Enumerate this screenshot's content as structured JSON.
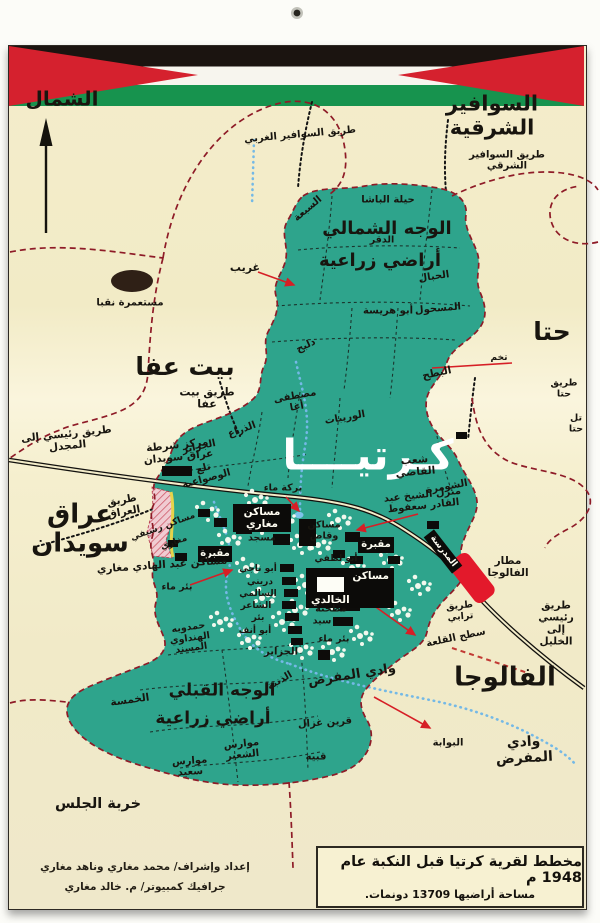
{
  "colors": {
    "paper_cream": "#f3ecc9",
    "village_green": "#2ea48c",
    "boundary_maroon": "#8e1b27",
    "arrow_red": "#d61f26",
    "wadi_blue": "#74b9e6",
    "flag_black": "#1b1410",
    "flag_white": "#f7f5ee",
    "flag_green": "#17934e",
    "flag_red": "#d5212e",
    "airport_red": "#e3192b"
  },
  "caption": {
    "line1": "مخطط لقرية كرتيا قبل النكبة عام 1948 م",
    "line2": "مساحة أراضيها 13709 دونمات."
  },
  "credits": {
    "line1": "إعداد وإشراف/ محمد مغاري وناهد مغاري",
    "line2": "جرافيك كمبيوتر/ م. خالد مغاري"
  },
  "compass": {
    "label": "الشمال"
  },
  "map": {
    "labels": [
      {
        "t": "الشمال",
        "x": 62,
        "y": 99,
        "s": 20
      },
      {
        "t": "السوافير الشرقية",
        "x": 492,
        "y": 116,
        "s": 21
      },
      {
        "t": "طريق السوافير الغربي",
        "x": 300,
        "y": 135,
        "s": 10,
        "r": -5
      },
      {
        "t": "طريق السوافير\nالشرقي",
        "x": 507,
        "y": 161,
        "s": 10
      },
      {
        "t": "حيلة الباشا",
        "x": 388,
        "y": 200,
        "s": 10
      },
      {
        "t": "السبعة",
        "x": 308,
        "y": 209,
        "s": 10,
        "r": -40
      },
      {
        "t": "الوجه الشمالي",
        "x": 387,
        "y": 229,
        "s": 18
      },
      {
        "t": "الدقر",
        "x": 382,
        "y": 241,
        "s": 9.5
      },
      {
        "t": "أراضي زراعية",
        "x": 380,
        "y": 261,
        "s": 18
      },
      {
        "t": "الحبال",
        "x": 434,
        "y": 277,
        "s": 10,
        "r": -8
      },
      {
        "t": "غريب",
        "x": 245,
        "y": 268,
        "s": 11
      },
      {
        "t": "المسحول",
        "x": 438,
        "y": 309,
        "s": 10,
        "r": -5
      },
      {
        "t": "أبو هريسة",
        "x": 388,
        "y": 311,
        "s": 10
      },
      {
        "t": "دلبح",
        "x": 306,
        "y": 346,
        "s": 10,
        "r": -25
      },
      {
        "t": "حتا",
        "x": 552,
        "y": 332,
        "s": 25
      },
      {
        "t": "تخم",
        "x": 499,
        "y": 358,
        "s": 9
      },
      {
        "t": "بيت عفا",
        "x": 185,
        "y": 367,
        "s": 25
      },
      {
        "t": "طريق بيت\nعفا",
        "x": 207,
        "y": 399,
        "s": 11
      },
      {
        "t": "البطح",
        "x": 437,
        "y": 374,
        "s": 10.5,
        "r": -12
      },
      {
        "t": "مصطفى\nأغا",
        "x": 296,
        "y": 402,
        "s": 10,
        "r": -10
      },
      {
        "t": "الوريبات",
        "x": 345,
        "y": 418,
        "s": 10,
        "r": -10
      },
      {
        "t": "طريق\nحتا",
        "x": 564,
        "y": 389,
        "s": 9.5
      },
      {
        "t": "تل حتا",
        "x": 576,
        "y": 424,
        "s": 9.5
      },
      {
        "t": "طريق رئيسي إلى\nالمجدل",
        "x": 67,
        "y": 441,
        "s": 10.5,
        "r": -6
      },
      {
        "t": "مركز شرطة\nعراق سويدان",
        "x": 178,
        "y": 452,
        "s": 10.5,
        "r": -6
      },
      {
        "t": "الذراع",
        "x": 242,
        "y": 430,
        "s": 10,
        "r": -20
      },
      {
        "t": "الجزاير",
        "x": 199,
        "y": 447,
        "s": 10,
        "r": -12
      },
      {
        "t": "كـرتيــــا",
        "x": 368,
        "y": 455,
        "s": 42,
        "c": "#ffffff"
      },
      {
        "t": "شعب\nالقاضي",
        "x": 415,
        "y": 467,
        "s": 10.5,
        "r": -5
      },
      {
        "t": "تلع\nالوصواعية",
        "x": 205,
        "y": 474,
        "s": 10,
        "r": -15
      },
      {
        "t": "الشومرة",
        "x": 447,
        "y": 487,
        "s": 10,
        "r": -10
      },
      {
        "t": "طريق\nالعراق",
        "x": 123,
        "y": 507,
        "s": 10.5,
        "r": -10
      },
      {
        "t": "منزل الشيخ عبد\nالقادر سعفوط",
        "x": 423,
        "y": 501,
        "s": 10,
        "r": -6
      },
      {
        "t": "بركة ماء",
        "x": 283,
        "y": 489,
        "s": 9.5
      },
      {
        "t": "عراق\nسويدان",
        "x": 80,
        "y": 530,
        "s": 26
      },
      {
        "t": "مساكن رسيفي",
        "x": 163,
        "y": 527,
        "s": 9,
        "r": -20
      },
      {
        "t": "مغاري",
        "x": 174,
        "y": 543,
        "s": 9,
        "r": -20
      },
      {
        "t": "مساكن عبد الهادي مغاري",
        "x": 162,
        "y": 566,
        "s": 10.5,
        "r": -4
      },
      {
        "t": "بئر ماء",
        "x": 177,
        "y": 588,
        "s": 9.5
      },
      {
        "t": "مسجد",
        "x": 262,
        "y": 539,
        "s": 9.5
      },
      {
        "t": "مساكن\nوقاص",
        "x": 324,
        "y": 531,
        "s": 9.5
      },
      {
        "t": "أبو لطفي",
        "x": 336,
        "y": 559,
        "s": 9
      },
      {
        "t": "أبو ناجي",
        "x": 258,
        "y": 569,
        "s": 9
      },
      {
        "t": "دريني",
        "x": 260,
        "y": 582,
        "s": 9
      },
      {
        "t": "السالمي",
        "x": 258,
        "y": 594,
        "s": 9
      },
      {
        "t": "الشاعر",
        "x": 256,
        "y": 606,
        "s": 9
      },
      {
        "t": "بئر",
        "x": 258,
        "y": 618,
        "s": 9
      },
      {
        "t": "أبو أنف",
        "x": 255,
        "y": 631,
        "s": 9
      },
      {
        "t": "مطحنة",
        "x": 331,
        "y": 610,
        "s": 9.5
      },
      {
        "t": "سيد",
        "x": 322,
        "y": 622,
        "s": 9.5
      },
      {
        "t": "بئر ماء",
        "x": 334,
        "y": 640,
        "s": 9.5
      },
      {
        "t": "وادي المفرض",
        "x": 352,
        "y": 676,
        "s": 13,
        "r": -9
      },
      {
        "t": "الجزاير",
        "x": 281,
        "y": 652,
        "s": 10
      },
      {
        "t": "حمدويه\nالهنداوي\nالمسند",
        "x": 190,
        "y": 639,
        "s": 9.5,
        "r": -8
      },
      {
        "t": "الذنبة",
        "x": 280,
        "y": 681,
        "s": 10,
        "r": -30
      },
      {
        "t": "الخمسة",
        "x": 130,
        "y": 701,
        "s": 10.5,
        "r": -8
      },
      {
        "t": "الوجه القبلي",
        "x": 222,
        "y": 691,
        "s": 17
      },
      {
        "t": "أراضي زراعية",
        "x": 213,
        "y": 719,
        "s": 17
      },
      {
        "t": "موارس\nالشعير",
        "x": 242,
        "y": 750,
        "s": 10,
        "r": -6
      },
      {
        "t": "موارس\nسعيد",
        "x": 190,
        "y": 767,
        "s": 10,
        "r": -4
      },
      {
        "t": "خربة الجلس",
        "x": 98,
        "y": 804,
        "s": 14.5
      },
      {
        "t": "قرين غزال",
        "x": 325,
        "y": 723,
        "s": 10,
        "r": -4
      },
      {
        "t": "قبيه",
        "x": 316,
        "y": 757,
        "s": 10
      },
      {
        "t": "البوابة",
        "x": 448,
        "y": 743,
        "s": 10
      },
      {
        "t": "الفالوجا",
        "x": 505,
        "y": 678,
        "s": 26
      },
      {
        "t": "وادي المفرض",
        "x": 524,
        "y": 751,
        "s": 14,
        "r": -3
      },
      {
        "t": "سطح القلعة",
        "x": 456,
        "y": 638,
        "s": 10,
        "r": -12
      },
      {
        "t": "طريق\nترابي",
        "x": 460,
        "y": 612,
        "s": 9.5,
        "r": -5
      },
      {
        "t": "طريق رئيسي إلى\nالخليل",
        "x": 556,
        "y": 624,
        "s": 10.5
      },
      {
        "t": "مطار\nالفالوجا",
        "x": 508,
        "y": 568,
        "s": 10.5
      },
      {
        "t": "مستعمرة نقبا",
        "x": 130,
        "y": 303,
        "s": 10
      }
    ],
    "plaques": [
      {
        "t": "مساكن مغاري",
        "x": 233,
        "y": 504,
        "w": 58,
        "h": 28,
        "fs": 10.5
      },
      {
        "t": "مقبرة",
        "x": 198,
        "y": 546,
        "w": 34,
        "h": 16,
        "fs": 10
      },
      {
        "t": "مقبرة",
        "x": 358,
        "y": 537,
        "w": 36,
        "h": 16,
        "fs": 10
      },
      {
        "t": "مساكن\nالخالدي",
        "x": 306,
        "y": 568,
        "w": 78,
        "h": 36,
        "fs": 10.5,
        "inner": true
      },
      {
        "t": "المدرسة",
        "x": 420,
        "y": 545,
        "w": 46,
        "h": 13,
        "fs": 9,
        "r": 52
      }
    ],
    "buildings": [
      [
        162,
        466,
        30,
        10
      ],
      [
        299,
        519,
        17,
        27
      ],
      [
        214,
        518,
        13,
        9
      ],
      [
        236,
        524,
        16,
        10
      ],
      [
        345,
        532,
        15,
        10
      ],
      [
        333,
        550,
        12,
        8
      ],
      [
        273,
        534,
        17,
        11
      ],
      [
        280,
        564,
        14,
        8
      ],
      [
        282,
        577,
        14,
        8
      ],
      [
        284,
        589,
        14,
        8
      ],
      [
        282,
        601,
        14,
        8
      ],
      [
        285,
        613,
        14,
        8
      ],
      [
        288,
        626,
        14,
        8
      ],
      [
        291,
        638,
        12,
        7
      ],
      [
        350,
        556,
        13,
        8
      ],
      [
        427,
        521,
        12,
        8
      ],
      [
        456,
        432,
        11,
        7
      ],
      [
        340,
        601,
        20,
        10
      ],
      [
        333,
        617,
        20,
        9
      ],
      [
        318,
        650,
        12,
        10
      ],
      [
        175,
        553,
        12,
        8
      ],
      [
        198,
        509,
        12,
        8
      ],
      [
        168,
        540,
        10,
        7
      ],
      [
        388,
        556,
        12,
        8
      ]
    ],
    "arrows": [
      [
        258,
        272,
        294,
        285,
        1
      ],
      [
        512,
        363,
        432,
        368,
        0
      ],
      [
        286,
        497,
        299,
        511,
        1
      ],
      [
        418,
        514,
        357,
        530,
        1
      ],
      [
        190,
        585,
        232,
        570,
        1
      ],
      [
        352,
        590,
        415,
        635,
        1
      ],
      [
        374,
        697,
        430,
        728,
        1
      ]
    ],
    "veg_clusters": [
      [
        206,
        512
      ],
      [
        228,
        540
      ],
      [
        246,
        568
      ],
      [
        262,
        598
      ],
      [
        282,
        622
      ],
      [
        305,
        585
      ],
      [
        318,
        545
      ],
      [
        338,
        520
      ],
      [
        300,
        545
      ],
      [
        352,
        568
      ],
      [
        372,
        592
      ],
      [
        398,
        612
      ],
      [
        282,
        518
      ],
      [
        220,
        622
      ],
      [
        248,
        640
      ],
      [
        300,
        650
      ],
      [
        332,
        652
      ],
      [
        360,
        636
      ],
      [
        390,
        560
      ],
      [
        418,
        586
      ],
      [
        260,
        525
      ],
      [
        295,
        610
      ],
      [
        330,
        600
      ],
      [
        255,
        500
      ]
    ]
  }
}
